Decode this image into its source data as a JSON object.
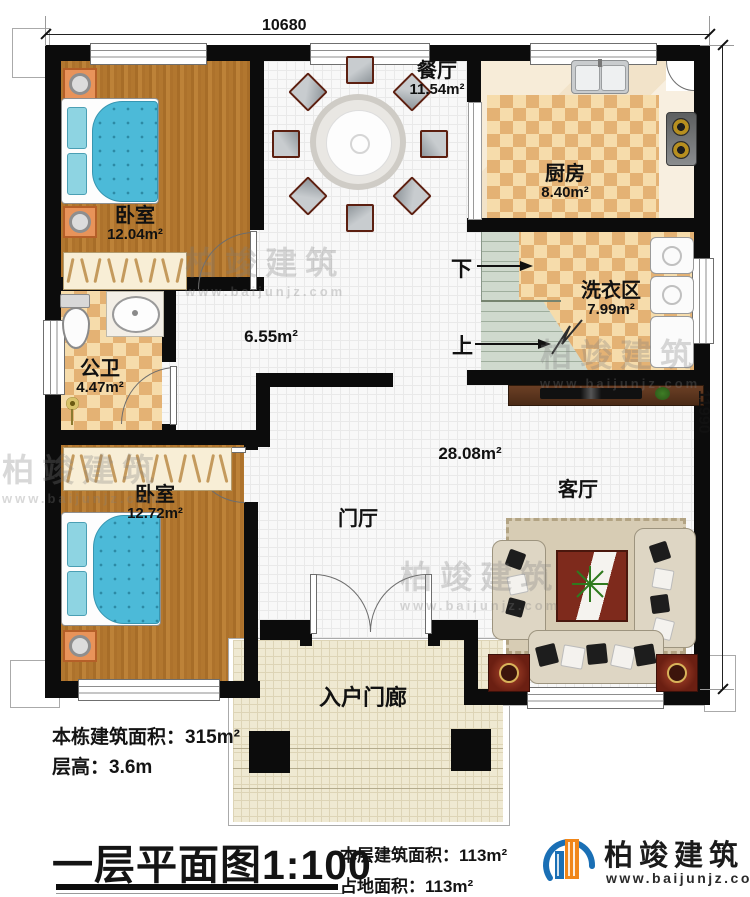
{
  "dimensions": {
    "top": "10680",
    "right": "11990"
  },
  "rooms": {
    "bedroom1": {
      "name": "卧室",
      "area": "12.04m²"
    },
    "dining": {
      "name": "餐厅",
      "area": "11.54m²"
    },
    "kitchen": {
      "name": "厨房",
      "area": "8.40m²"
    },
    "laundry": {
      "name": "洗衣区",
      "area": "7.99m²"
    },
    "bathroom": {
      "name": "公卫",
      "area": "4.47m²"
    },
    "bedroom2": {
      "name": "卧室",
      "area": "12.72m²"
    },
    "hallway": {
      "name": "门厅"
    },
    "living": {
      "name": "客厅",
      "area": "28.08m²"
    },
    "porch": {
      "name": "入户门廊"
    },
    "corridor": {
      "area": "6.55m²"
    }
  },
  "stairs": {
    "down": "下",
    "up": "上"
  },
  "info": {
    "total_area": "本栋建筑面积：315m²",
    "floor_height": "层高：3.6m"
  },
  "title": {
    "main": "一层平面图",
    "scale": "1:100",
    "floor_area": "本层建筑面积：113m²",
    "footprint": "占地面积：113m²"
  },
  "logo": {
    "name": "柏竣建筑",
    "url": "www.baijunjz.com"
  },
  "watermark": {
    "name": "柏竣建筑",
    "url": "www.baijunjz.com"
  },
  "colors": {
    "wall": "#0c0c0c",
    "logo_blue": "#1a6fb5",
    "logo_orange": "#f08619",
    "quilt": "#4cbad8"
  }
}
